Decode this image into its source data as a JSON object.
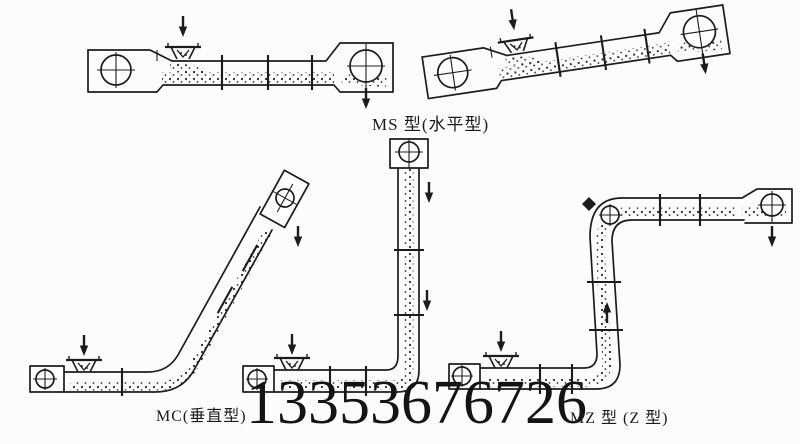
{
  "page": {
    "background": "#fcfcfb",
    "ink": "#1c1c1c"
  },
  "labels": {
    "ms": "MS 型(水平型)",
    "mc": "MC(垂直型)",
    "mz": "MZ 型 (Z 型)"
  },
  "watermark": {
    "phone": "13353676726",
    "color": "#141414"
  },
  "figures": [
    {
      "name": "ms-horizontal-conveyor-figure"
    },
    {
      "name": "ms-inclined-conveyor-figure"
    },
    {
      "name": "mc-vertical-conveyor-figure"
    },
    {
      "name": "l-shaped-conveyor-figure"
    },
    {
      "name": "mz-z-shaped-conveyor-figure"
    }
  ]
}
